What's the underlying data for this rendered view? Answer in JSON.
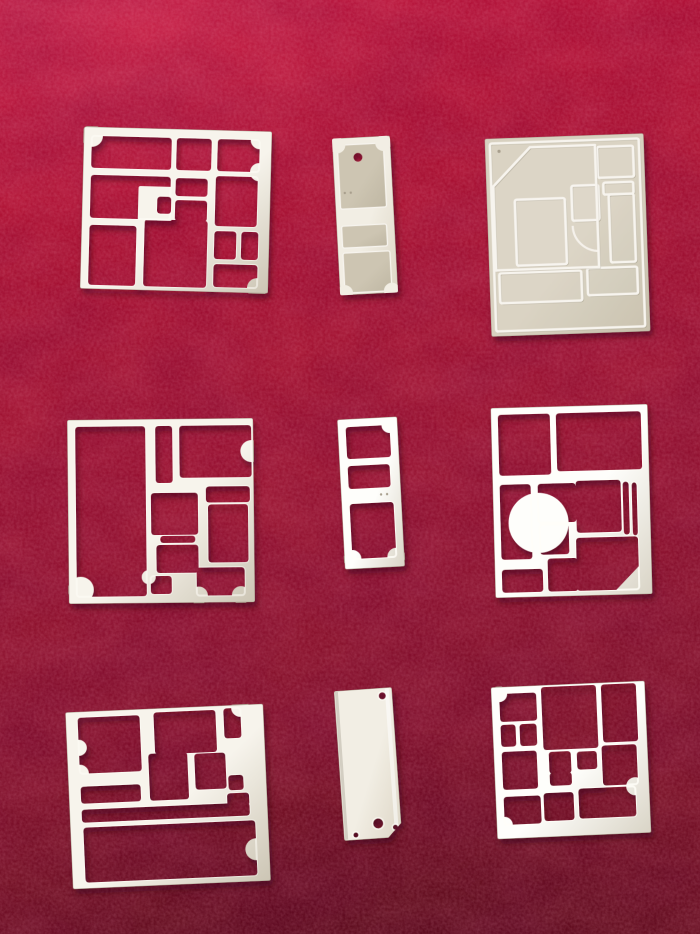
{
  "scene": {
    "description": "Nine stamped sheet-metal EMI shielding frames and cover plates arranged in a 3x3 grid on red velvet",
    "background": {
      "top": "#c2143a",
      "upper": "#ae1232",
      "mid": "#9c1330",
      "lower": "#84112a",
      "bottom": "#6e1120",
      "highlight": "#e8537a",
      "vignette": "#2e030c"
    },
    "metal": {
      "frame_hi": "#f7f4ec",
      "frame_lo": "#ccc5b4",
      "bright_hi": "#fefefb",
      "bright_lo": "#d9d4c6",
      "lid_hi": "#f2eee4",
      "lid_lo": "#ddd6c6",
      "plate_hi": "#d8d1c0",
      "plate_lo": "#c7bfab",
      "panel_hi": "#cdc5b2",
      "panel_lo": "#bfb7a3",
      "edge": "#b2ab99",
      "glint": "#fffef8",
      "ridge_hi": "#f7f4ee",
      "ridge_lo": "#7f7763",
      "dot": "#a89f8d",
      "shadow": "#30030d"
    }
  },
  "parts": [
    {
      "id": "shield-frame-top-left",
      "label": "stamped shield frame",
      "type": "frame",
      "tone": "frame",
      "x": 82,
      "y": 129,
      "w": 188,
      "h": 162,
      "rotate": 1.5,
      "holes": [
        [
          8,
          9,
          80,
          32
        ],
        [
          93,
          9,
          35,
          32
        ],
        [
          134,
          9,
          42,
          32
        ],
        [
          8,
          48,
          80,
          43
        ],
        [
          93,
          49,
          32,
          18
        ],
        [
          93,
          71,
          32,
          21
        ],
        [
          133,
          46,
          42,
          50
        ],
        [
          8,
          98,
          47,
          60
        ],
        [
          63,
          91,
          63,
          67
        ],
        [
          133,
          101,
          22,
          28
        ],
        [
          160,
          101,
          17,
          28
        ],
        [
          133,
          134,
          44,
          23
        ]
      ],
      "adds": [
        [
          56,
          58,
          34,
          34
        ]
      ],
      "holes2": [
        [
          75,
          68,
          14,
          17
        ]
      ],
      "scallops": [
        [
          8,
          9,
          11
        ],
        [
          176,
          9,
          9
        ],
        [
          176,
          41,
          9
        ],
        [
          177,
          157,
          10
        ]
      ]
    },
    {
      "id": "shield-cover-tag-top-center",
      "label": "small cover plate with pilot hole",
      "type": "lid",
      "tone": "lid",
      "x": 336,
      "y": 137,
      "w": 58,
      "h": 157,
      "rotate": -3,
      "panels": [
        [
          5,
          7,
          46,
          64
        ],
        [
          5,
          88,
          45,
          22
        ],
        [
          5,
          115,
          47,
          40
        ]
      ],
      "panel_scallops": [
        [
          5,
          7,
          8
        ],
        [
          51,
          7,
          8
        ],
        [
          5,
          155,
          8
        ],
        [
          52,
          155,
          8
        ]
      ],
      "circle_holes": [
        [
          25,
          20,
          4.5
        ]
      ],
      "dots": [
        [
          10,
          55,
          1.2
        ],
        [
          16,
          55,
          1.2
        ]
      ]
    },
    {
      "id": "shield-cover-plate-top-right",
      "label": "embossed shield cover plate",
      "type": "embossed",
      "tone": "plate",
      "x": 488,
      "y": 136,
      "w": 159,
      "h": 198,
      "rotate": -2,
      "ridges": [
        [
          5,
          5,
          149,
          188
        ],
        [
          112,
          12,
          36,
          31
        ],
        [
          117,
          48,
          30,
          12
        ],
        [
          85,
          50,
          27,
          35
        ],
        [
          28,
          62,
          50,
          66
        ],
        [
          122,
          60,
          25,
          68
        ],
        [
          10,
          135,
          82,
          30
        ],
        [
          98,
          133,
          50,
          27
        ]
      ],
      "polys": [
        [
          45,
          10,
          110,
          10,
          110,
          132,
          7,
          132,
          7,
          48
        ]
      ],
      "paths": [
        "M 85,90 A 26,26 0 0 0 111,116"
      ],
      "dots": [
        [
          14,
          13,
          1.6
        ]
      ]
    },
    {
      "id": "shield-frame-middle-left",
      "label": "stamped shield frame",
      "type": "frame",
      "tone": "frame",
      "x": 68,
      "y": 419,
      "w": 186,
      "h": 184,
      "rotate": -0.6,
      "holes": [
        [
          8,
          7,
          70,
          170
        ],
        [
          88,
          7,
          17,
          57
        ],
        [
          112,
          7,
          72,
          52
        ],
        [
          83,
          74,
          47,
          42
        ],
        [
          138,
          68,
          44,
          16
        ],
        [
          140,
          86,
          40,
          58
        ],
        [
          92,
          117,
          35,
          7
        ],
        [
          88,
          126,
          42,
          28
        ],
        [
          82,
          157,
          21,
          18
        ],
        [
          128,
          149,
          48,
          28
        ]
      ],
      "scallops": [
        [
          12,
          170,
          13
        ],
        [
          184,
          33,
          11
        ],
        [
          80,
          158,
          7
        ],
        [
          130,
          177,
          9
        ],
        [
          172,
          177,
          9
        ]
      ]
    },
    {
      "id": "shield-frame-small-middle-center",
      "label": "small three-cavity frame",
      "type": "frame",
      "tone": "bright",
      "x": 341,
      "y": 418,
      "w": 60,
      "h": 150,
      "rotate": -3,
      "holes": [
        [
          8,
          8,
          44,
          32
        ],
        [
          8,
          47,
          42,
          23
        ],
        [
          8,
          85,
          44,
          55
        ]
      ],
      "scallops": [
        [
          52,
          8,
          8
        ],
        [
          8,
          140,
          9
        ],
        [
          52,
          140,
          9
        ]
      ],
      "dots": [
        [
          40,
          77,
          1.2
        ],
        [
          46,
          77,
          1.2
        ]
      ]
    },
    {
      "id": "shield-frame-middle-right",
      "label": "bright shield frame with quarter-disc web",
      "type": "frame",
      "tone": "bright",
      "x": 493,
      "y": 406,
      "w": 157,
      "h": 190,
      "rotate": -1.5,
      "holes": [
        [
          7,
          7,
          52,
          61
        ],
        [
          65,
          7,
          85,
          58
        ],
        [
          7,
          77,
          31,
          75
        ],
        [
          45,
          77,
          38,
          39
        ],
        [
          83,
          75,
          45,
          52
        ],
        [
          130,
          77,
          6,
          53
        ],
        [
          139,
          78,
          5,
          53
        ],
        [
          46,
          118,
          29,
          30
        ],
        [
          7,
          162,
          41,
          23
        ],
        [
          53,
          152,
          30,
          33
        ],
        [
          82,
          132,
          62,
          53
        ]
      ],
      "scallops": [
        [
          45,
          116,
          30
        ]
      ],
      "tris": [
        [
          144,
          162,
          144,
          185,
          121,
          185
        ]
      ]
    },
    {
      "id": "shield-frame-bottom-left",
      "label": "stamped shield frame",
      "type": "frame",
      "tone": "frame",
      "x": 69,
      "y": 708,
      "w": 198,
      "h": 177,
      "rotate": -2.5,
      "holes": [
        [
          12,
          6,
          62,
          56
        ],
        [
          88,
          4,
          62,
          42
        ],
        [
          158,
          3,
          17,
          30
        ],
        [
          12,
          75,
          60,
          17
        ],
        [
          81,
          45,
          39,
          47
        ],
        [
          127,
          47,
          31,
          36
        ],
        [
          160,
          70,
          15,
          15
        ],
        [
          158,
          88,
          22,
          13
        ],
        [
          12,
          98,
          168,
          13
        ],
        [
          13,
          116,
          172,
          55
        ]
      ],
      "scallops": [
        [
          12,
          62,
          9
        ],
        [
          12,
          36,
          8
        ],
        [
          175,
          3,
          9
        ],
        [
          185,
          145,
          11
        ]
      ]
    },
    {
      "id": "blank-cover-plate-bottom-center",
      "label": "blank cover plate with mounting holes",
      "type": "blank",
      "tone": "lid",
      "x": 339,
      "y": 689,
      "w": 58,
      "h": 150,
      "rotate": -4,
      "circle_holes": [
        [
          48,
          8,
          3.5
        ],
        [
          35,
          135,
          5
        ],
        [
          52,
          140,
          2.5
        ],
        [
          12,
          145,
          2.5
        ]
      ],
      "tri_holes": [
        [
          58,
          136,
          58,
          150,
          44,
          150
        ]
      ]
    },
    {
      "id": "shield-frame-bottom-right",
      "label": "bright multi-cavity shield frame",
      "type": "frame",
      "tone": "bright",
      "x": 494,
      "y": 684,
      "w": 154,
      "h": 152,
      "rotate": -2.5,
      "holes": [
        [
          8,
          7,
          37,
          28
        ],
        [
          50,
          2,
          55,
          63
        ],
        [
          110,
          2,
          35,
          58
        ],
        [
          8,
          38,
          15,
          22
        ],
        [
          27,
          38,
          17,
          22
        ],
        [
          8,
          65,
          35,
          38
        ],
        [
          55,
          67,
          22,
          22
        ],
        [
          55,
          88,
          22,
          13
        ],
        [
          83,
          68,
          20,
          18
        ],
        [
          108,
          63,
          35,
          40
        ],
        [
          8,
          110,
          37,
          28
        ],
        [
          48,
          108,
          30,
          28
        ],
        [
          83,
          105,
          57,
          30
        ]
      ],
      "scallops": [
        [
          8,
          7,
          8
        ],
        [
          8,
          138,
          8
        ],
        [
          140,
          105,
          9
        ]
      ]
    }
  ]
}
